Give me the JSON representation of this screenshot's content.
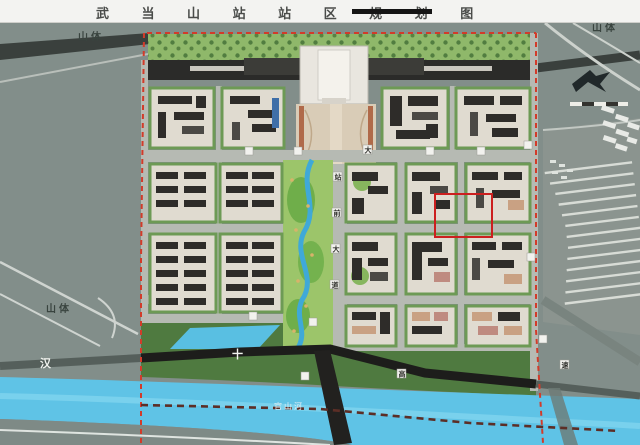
{
  "title": {
    "text": "武 当 山 站 站 区 规 划 图"
  },
  "labels": {
    "mountain_top_left": "山体",
    "mountain_left": "山体",
    "mountain_top_right": "山体",
    "river_name": "官山河",
    "expressway": {
      "char1": "汉",
      "char2": "十",
      "char3": "高",
      "char4": "速"
    },
    "station_avenue": {
      "char1": "站",
      "char2": "前",
      "char3": "大",
      "char4": "道"
    },
    "road_label_da": "大"
  },
  "colors": {
    "boundary_red": "#d23b2a",
    "highlight_red": "#cc1f1f",
    "river_cyan": "#5fc3e6",
    "park_green": "#9cc56a",
    "terrain_gray": "#828e8a",
    "highway_black": "#1d1d1b"
  }
}
